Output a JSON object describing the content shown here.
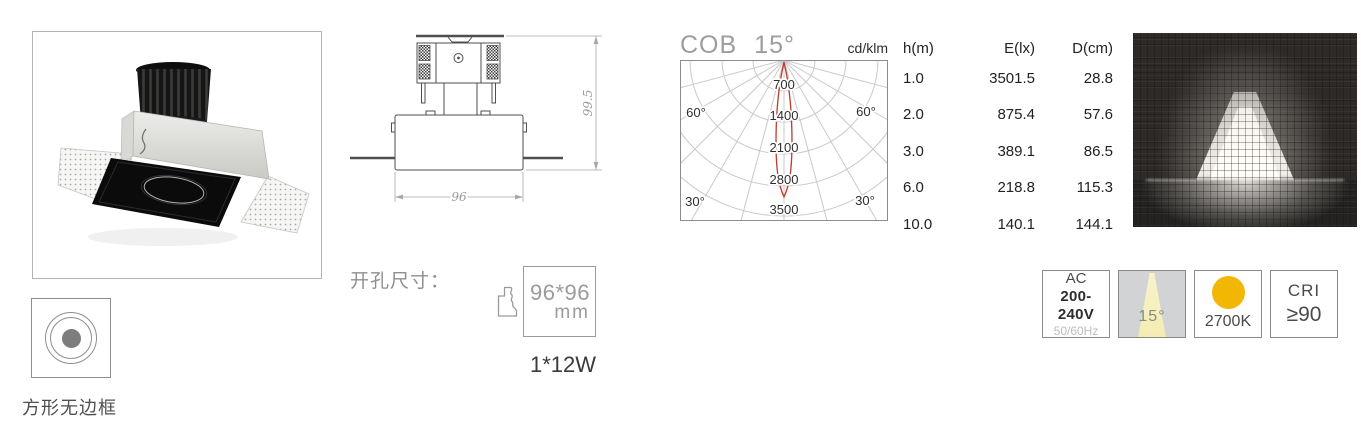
{
  "product": {
    "caption": "方形无边框"
  },
  "drawing": {
    "height_dim": "99.5",
    "width_dim": "96"
  },
  "cutout": {
    "label": "开孔尺寸：",
    "size": "96*96",
    "unit": "mm",
    "wattage": "1*12W"
  },
  "chart_data": {
    "type": "polar-intensity",
    "title": "COB",
    "beam_angle": "15°",
    "unit": "cd/klm",
    "ring_labels": [
      "700",
      "1400",
      "2100",
      "2800",
      "3500"
    ],
    "angle_labels": {
      "left_60": "60°",
      "right_60": "60°",
      "left_30": "30°",
      "right_30": "30°"
    },
    "curve": {
      "color": "#c0392b",
      "peak_cd_per_klm": 3000,
      "beam_angle_deg": 15
    },
    "spacing_table": {
      "headers": [
        "h(m)",
        "E(lx)",
        "D(cm)"
      ],
      "rows": [
        [
          "1.0",
          "3501.5",
          "28.8"
        ],
        [
          "2.0",
          "875.4",
          "57.6"
        ],
        [
          "3.0",
          "389.1",
          "86.5"
        ],
        [
          "6.0",
          "218.8",
          "115.3"
        ],
        [
          "10.0",
          "140.1",
          "144.1"
        ]
      ]
    }
  },
  "badges": {
    "power": {
      "line1": "AC",
      "line2": "200-240V",
      "line3": "50/60Hz"
    },
    "beam": {
      "label": "15°",
      "cone_color": "#f5f1bd"
    },
    "cct": {
      "label": "2700K",
      "dot_color": "#f2b705"
    },
    "cri": {
      "line1": "CRI",
      "line2": "≥90"
    }
  }
}
